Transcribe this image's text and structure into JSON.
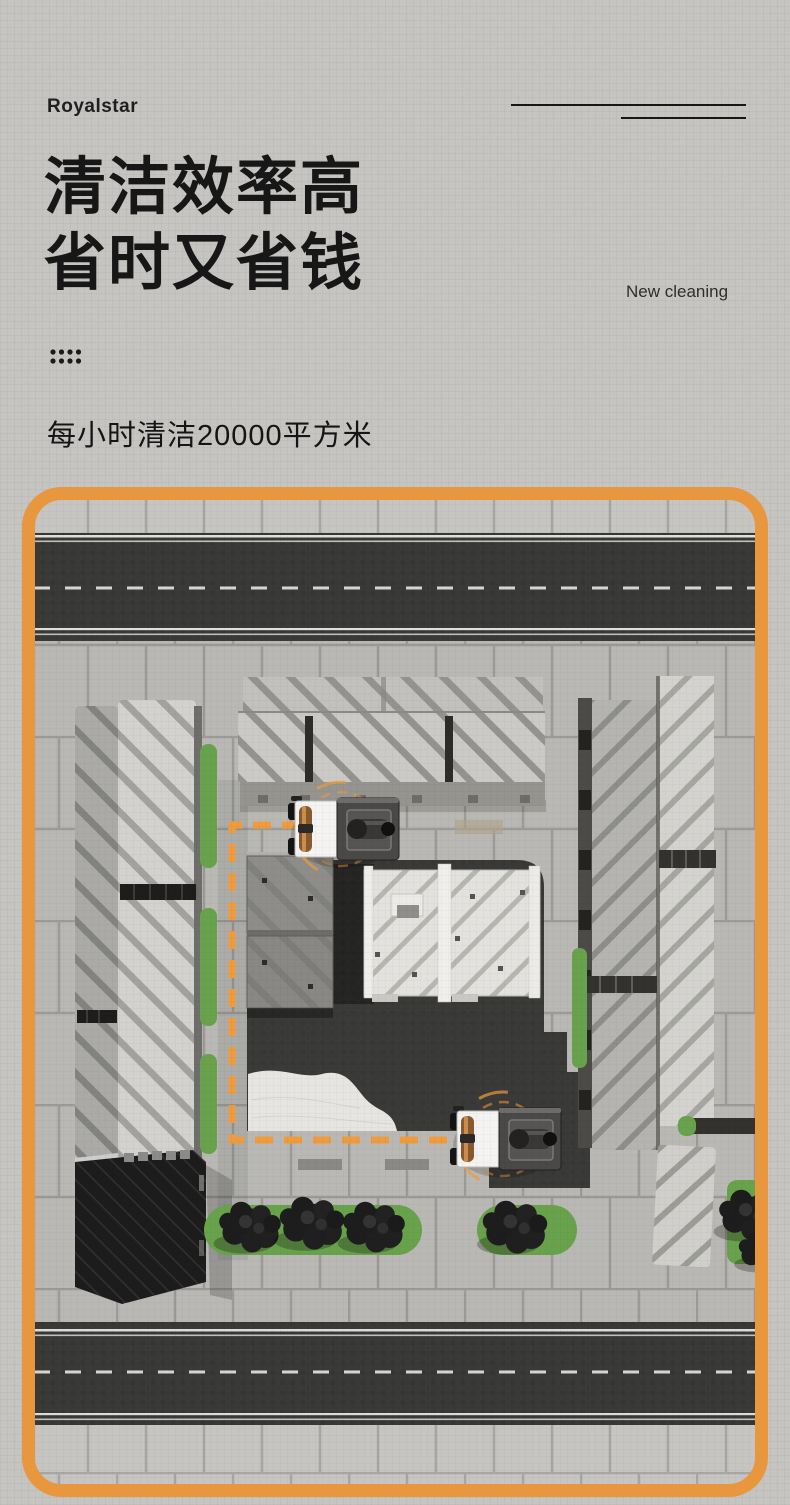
{
  "header": {
    "brand": "Royalstar",
    "title_line1": "清洁效率高",
    "title_line2": "省时又省钱",
    "tagline": "New cleaning",
    "subtitle": "每小时清洁20000平方米"
  },
  "colors": {
    "accent_orange": "#E8973E",
    "route_orange": "#F09B3E",
    "text_dark": "#1b1b1b",
    "page_background": "#c8c7c4",
    "greenery": "#69a24c",
    "asphalt": "#3b3a38"
  }
}
